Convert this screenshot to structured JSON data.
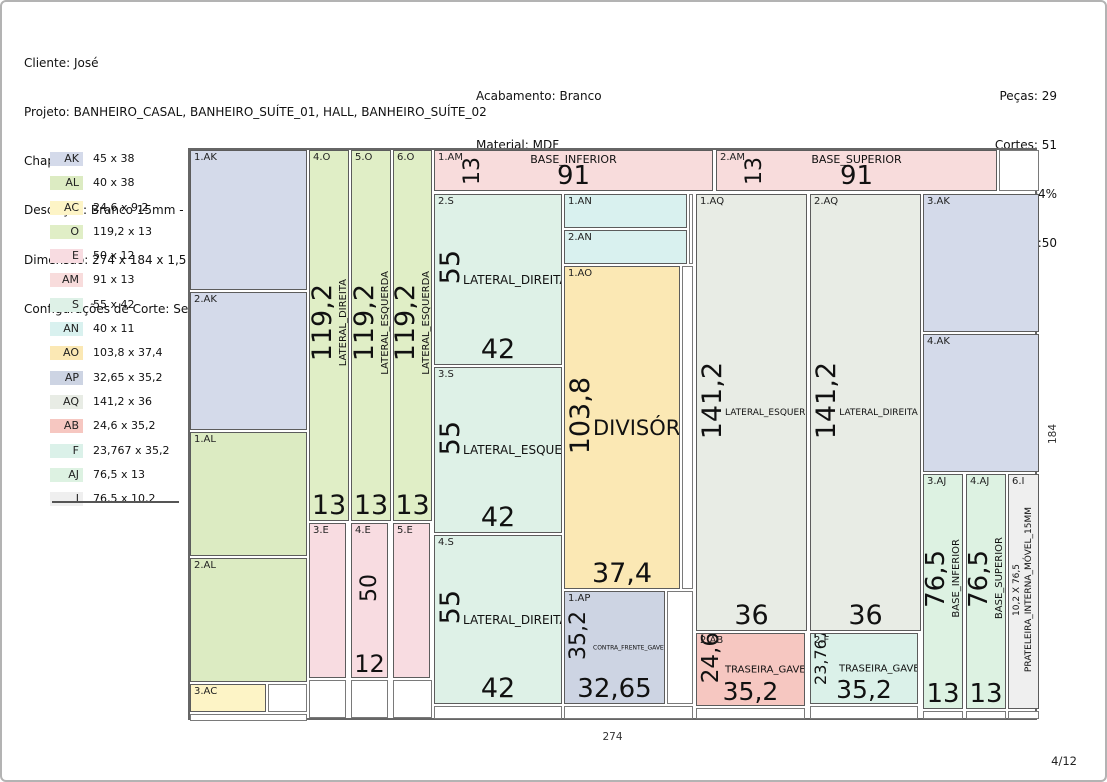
{
  "header": {
    "left": [
      "Cliente: José",
      "Projeto: BANHEIRO_CASAL, BANHEIRO_SUÍTE_01, HALL, BANHEIRO_SUÍTE_02",
      "Chapa 4",
      "Descrição: Branco 15mm - Cod.: 10015",
      "Dimensão: 274 x 184 x 1,5",
      "Configurações de Corte: Serra - Nenhum"
    ],
    "center": [
      "Acabamento: Branco",
      "Material: MDF",
      "Fornecedor:"
    ],
    "right": [
      "Peças: 29",
      "Cortes: 51",
      "Aproveitamento: 92,04%",
      "Data/Hora: 06/02/2026 08:50"
    ]
  },
  "legend": {
    "items": [
      {
        "code": "AK",
        "dims": "45 x 38",
        "color": "#d4daea"
      },
      {
        "code": "AL",
        "dims": "40 x 38",
        "color": "#dcebc2"
      },
      {
        "code": "AC",
        "dims": "24,6 x 9,2",
        "color": "#fdf4c6"
      },
      {
        "code": "O",
        "dims": "119,2 x 13",
        "color": "#e0eec6"
      },
      {
        "code": "E",
        "dims": "50 x 12",
        "color": "#f8dce1"
      },
      {
        "code": "AM",
        "dims": "91 x 13",
        "color": "#f8dcdc"
      },
      {
        "code": "S",
        "dims": "55 x 42",
        "color": "#def1e7"
      },
      {
        "code": "AN",
        "dims": "40 x 11",
        "color": "#d9f1ef"
      },
      {
        "code": "AO",
        "dims": "103,8 x 37,4",
        "color": "#fbe8b4"
      },
      {
        "code": "AP",
        "dims": "32,65 x 35,2",
        "color": "#cdd4e3"
      },
      {
        "code": "AQ",
        "dims": "141,2 x 36",
        "color": "#e8ece5"
      },
      {
        "code": "AB",
        "dims": "24,6 x 35,2",
        "color": "#f6c7c1"
      },
      {
        "code": "F",
        "dims": "23,767 x 35,2",
        "color": "#dbf1e9"
      },
      {
        "code": "AJ",
        "dims": "76,5 x 13",
        "color": "#ddf2e2"
      },
      {
        "code": "I",
        "dims": "76,5 x 10,2",
        "color": "#efefef"
      }
    ]
  },
  "sheet": {
    "width_label": "274",
    "height_label": "184",
    "pieces": [
      {
        "code": "1.AK",
        "color": "AK",
        "variant": "plain",
        "x": 0,
        "y": 0,
        "w": 117,
        "h": 140
      },
      {
        "code": "2.AK",
        "color": "AK",
        "variant": "plain",
        "x": 0,
        "y": 142,
        "w": 117,
        "h": 138
      },
      {
        "code": "1.AL",
        "color": "AL",
        "variant": "plain",
        "x": 0,
        "y": 282,
        "w": 117,
        "h": 124
      },
      {
        "code": "2.AL",
        "color": "AL",
        "variant": "plain",
        "x": 0,
        "y": 408,
        "w": 117,
        "h": 124
      },
      {
        "code": "3.AC",
        "color": "AC",
        "variant": "plain",
        "x": 0,
        "y": 534,
        "w": 76,
        "h": 28
      },
      {
        "code": "4.O",
        "color": "O",
        "variant": "vcol",
        "x": 119,
        "y": 0,
        "w": 40,
        "h": 371,
        "vdim": "119,2",
        "vdim_size": 27,
        "vname": "LATERAL_DIREITA",
        "bdim": "13",
        "bdim_size": 27
      },
      {
        "code": "5.O",
        "color": "O",
        "variant": "vcol",
        "x": 161,
        "y": 0,
        "w": 40,
        "h": 371,
        "vdim": "119,2",
        "vdim_size": 27,
        "vname": "LATERAL_ESQUERDA",
        "bdim": "13",
        "bdim_size": 27
      },
      {
        "code": "6.O",
        "color": "O",
        "variant": "vcol",
        "x": 203,
        "y": 0,
        "w": 39,
        "h": 371,
        "vdim": "119,2",
        "vdim_size": 27,
        "vname": "LATERAL_ESQUERDA",
        "bdim": "13",
        "bdim_size": 27
      },
      {
        "code": "3.E",
        "color": "E",
        "variant": "plain",
        "x": 119,
        "y": 373,
        "w": 37,
        "h": 155
      },
      {
        "code": "4.E",
        "color": "E",
        "variant": "vcol",
        "x": 161,
        "y": 373,
        "w": 37,
        "h": 155,
        "vdim": "50",
        "vdim_size": 22,
        "bdim": "12",
        "bdim_size": 24
      },
      {
        "code": "5.E",
        "color": "E",
        "variant": "plain",
        "x": 203,
        "y": 373,
        "w": 37,
        "h": 155
      },
      {
        "code": "1.AM",
        "color": "AM",
        "variant": "hbar",
        "x": 244,
        "y": 0,
        "w": 279,
        "h": 41,
        "vdim": "13",
        "vdim_size": 22,
        "hname": "BASE_INFERIOR",
        "hname_size": 11,
        "bdim": "91",
        "bdim_size": 26
      },
      {
        "code": "2.AM",
        "color": "AM",
        "variant": "hbar",
        "x": 526,
        "y": 0,
        "w": 281,
        "h": 41,
        "vdim": "13",
        "vdim_size": 22,
        "hname": "BASE_SUPERIOR",
        "hname_size": 11,
        "bdim": "91",
        "bdim_size": 26
      },
      {
        "code": "2.S",
        "color": "S",
        "variant": "panel",
        "x": 244,
        "y": 44,
        "w": 128,
        "h": 171,
        "vdim": "55",
        "vdim_size": 27,
        "hname": "LATERAL_DIREITA",
        "hname_size": 12,
        "bdim": "42",
        "bdim_size": 27
      },
      {
        "code": "3.S",
        "color": "S",
        "variant": "panel",
        "x": 244,
        "y": 217,
        "w": 128,
        "h": 166,
        "vdim": "55",
        "vdim_size": 27,
        "hname": "LATERAL_ESQUERDA",
        "hname_size": 12,
        "bdim": "42",
        "bdim_size": 27
      },
      {
        "code": "4.S",
        "color": "S",
        "variant": "panel",
        "x": 244,
        "y": 385,
        "w": 128,
        "h": 169,
        "vdim": "55",
        "vdim_size": 27,
        "hname": "LATERAL_DIREITA",
        "hname_size": 12,
        "bdim": "42",
        "bdim_size": 27
      },
      {
        "code": "1.AN",
        "color": "AN",
        "variant": "plain",
        "x": 374,
        "y": 44,
        "w": 123,
        "h": 34
      },
      {
        "code": "2.AN",
        "color": "AN",
        "variant": "plain",
        "x": 374,
        "y": 80,
        "w": 123,
        "h": 34
      },
      {
        "code": "1.AO",
        "color": "AO",
        "variant": "panel",
        "x": 374,
        "y": 116,
        "w": 116,
        "h": 323,
        "vdim": "103,8",
        "vdim_size": 27,
        "hname": "DIVISÓRIA",
        "hname_size": 21,
        "bdim": "37,4",
        "bdim_size": 27
      },
      {
        "code": "1.AP",
        "color": "AP",
        "variant": "panel",
        "x": 374,
        "y": 441,
        "w": 101,
        "h": 113,
        "vdim": "35,2",
        "vdim_size": 22,
        "hname": "CONTRA_FRENTE_GAVETA",
        "hname_size": 6,
        "bdim": "32,65",
        "bdim_size": 26
      },
      {
        "code": "1.AQ",
        "color": "AQ",
        "variant": "panel",
        "x": 506,
        "y": 44,
        "w": 111,
        "h": 437,
        "vdim": "141,2",
        "vdim_size": 27,
        "hname": "LATERAL_ESQUERDA",
        "hname_size": 9,
        "bdim": "36",
        "bdim_size": 27
      },
      {
        "code": "2.AQ",
        "color": "AQ",
        "variant": "panel",
        "x": 620,
        "y": 44,
        "w": 111,
        "h": 437,
        "vdim": "141,2",
        "vdim_size": 27,
        "hname": "LATERAL_DIREITA",
        "hname_size": 9,
        "bdim": "36",
        "bdim_size": 27
      },
      {
        "code": "2.AB",
        "color": "AB",
        "variant": "panel",
        "x": 506,
        "y": 483,
        "w": 109,
        "h": 73,
        "vdim": "24,6",
        "vdim_size": 23,
        "hname": "TRASEIRA_GAVETA",
        "hname_size": 10,
        "bdim": "35,2",
        "bdim_size": 25
      },
      {
        "code": "2.F",
        "color": "F",
        "variant": "panel",
        "x": 620,
        "y": 483,
        "w": 108,
        "h": 71,
        "vdim": "23,767",
        "vdim_size": 16,
        "hname": "TRASEIRA_GAVETA",
        "hname_size": 10,
        "bdim": "35,2",
        "bdim_size": 25
      },
      {
        "code": "3.AK",
        "color": "AK",
        "variant": "plain",
        "x": 733,
        "y": 44,
        "w": 116,
        "h": 138
      },
      {
        "code": "4.AK",
        "color": "AK",
        "variant": "plain",
        "x": 733,
        "y": 184,
        "w": 116,
        "h": 138
      },
      {
        "code": "3.AJ",
        "color": "AJ",
        "variant": "vcol",
        "x": 733,
        "y": 324,
        "w": 40,
        "h": 235,
        "vdim": "76,5",
        "vdim_size": 26,
        "vname": "BASE_INFERIOR",
        "bdim": "13",
        "bdim_size": 26
      },
      {
        "code": "4.AJ",
        "color": "AJ",
        "variant": "vcol",
        "x": 776,
        "y": 324,
        "w": 40,
        "h": 235,
        "vdim": "76,5",
        "vdim_size": 26,
        "vname": "BASE_SUPERIOR",
        "bdim": "13",
        "bdim_size": 26
      },
      {
        "code": "6.I",
        "color": "I",
        "variant": "vcol",
        "x": 818,
        "y": 324,
        "w": 31,
        "h": 235,
        "vname": "10,2 X 76,5",
        "vname2": "PRATELEIRA_INTERNA_MÓVEL_15MM"
      }
    ],
    "wastes": [
      {
        "x": 809,
        "y": 0,
        "w": 40,
        "h": 41
      },
      {
        "x": 499,
        "y": 44,
        "w": 4,
        "h": 70
      },
      {
        "x": 492,
        "y": 116,
        "w": 11,
        "h": 323
      },
      {
        "x": 477,
        "y": 441,
        "w": 26,
        "h": 113
      },
      {
        "x": 78,
        "y": 534,
        "w": 39,
        "h": 28
      },
      {
        "x": 119,
        "y": 530,
        "w": 37,
        "h": 38
      },
      {
        "x": 161,
        "y": 530,
        "w": 37,
        "h": 38
      },
      {
        "x": 203,
        "y": 530,
        "w": 39,
        "h": 38
      },
      {
        "x": 0,
        "y": 564,
        "w": 117,
        "h": 7
      },
      {
        "x": 244,
        "y": 556,
        "w": 128,
        "h": 13
      },
      {
        "x": 374,
        "y": 556,
        "w": 129,
        "h": 13
      },
      {
        "x": 506,
        "y": 558,
        "w": 109,
        "h": 11
      },
      {
        "x": 620,
        "y": 556,
        "w": 108,
        "h": 13
      },
      {
        "x": 733,
        "y": 561,
        "w": 40,
        "h": 8
      },
      {
        "x": 776,
        "y": 561,
        "w": 40,
        "h": 8
      },
      {
        "x": 818,
        "y": 561,
        "w": 31,
        "h": 8
      }
    ]
  },
  "footer": {
    "page_indicator": "4/12"
  }
}
